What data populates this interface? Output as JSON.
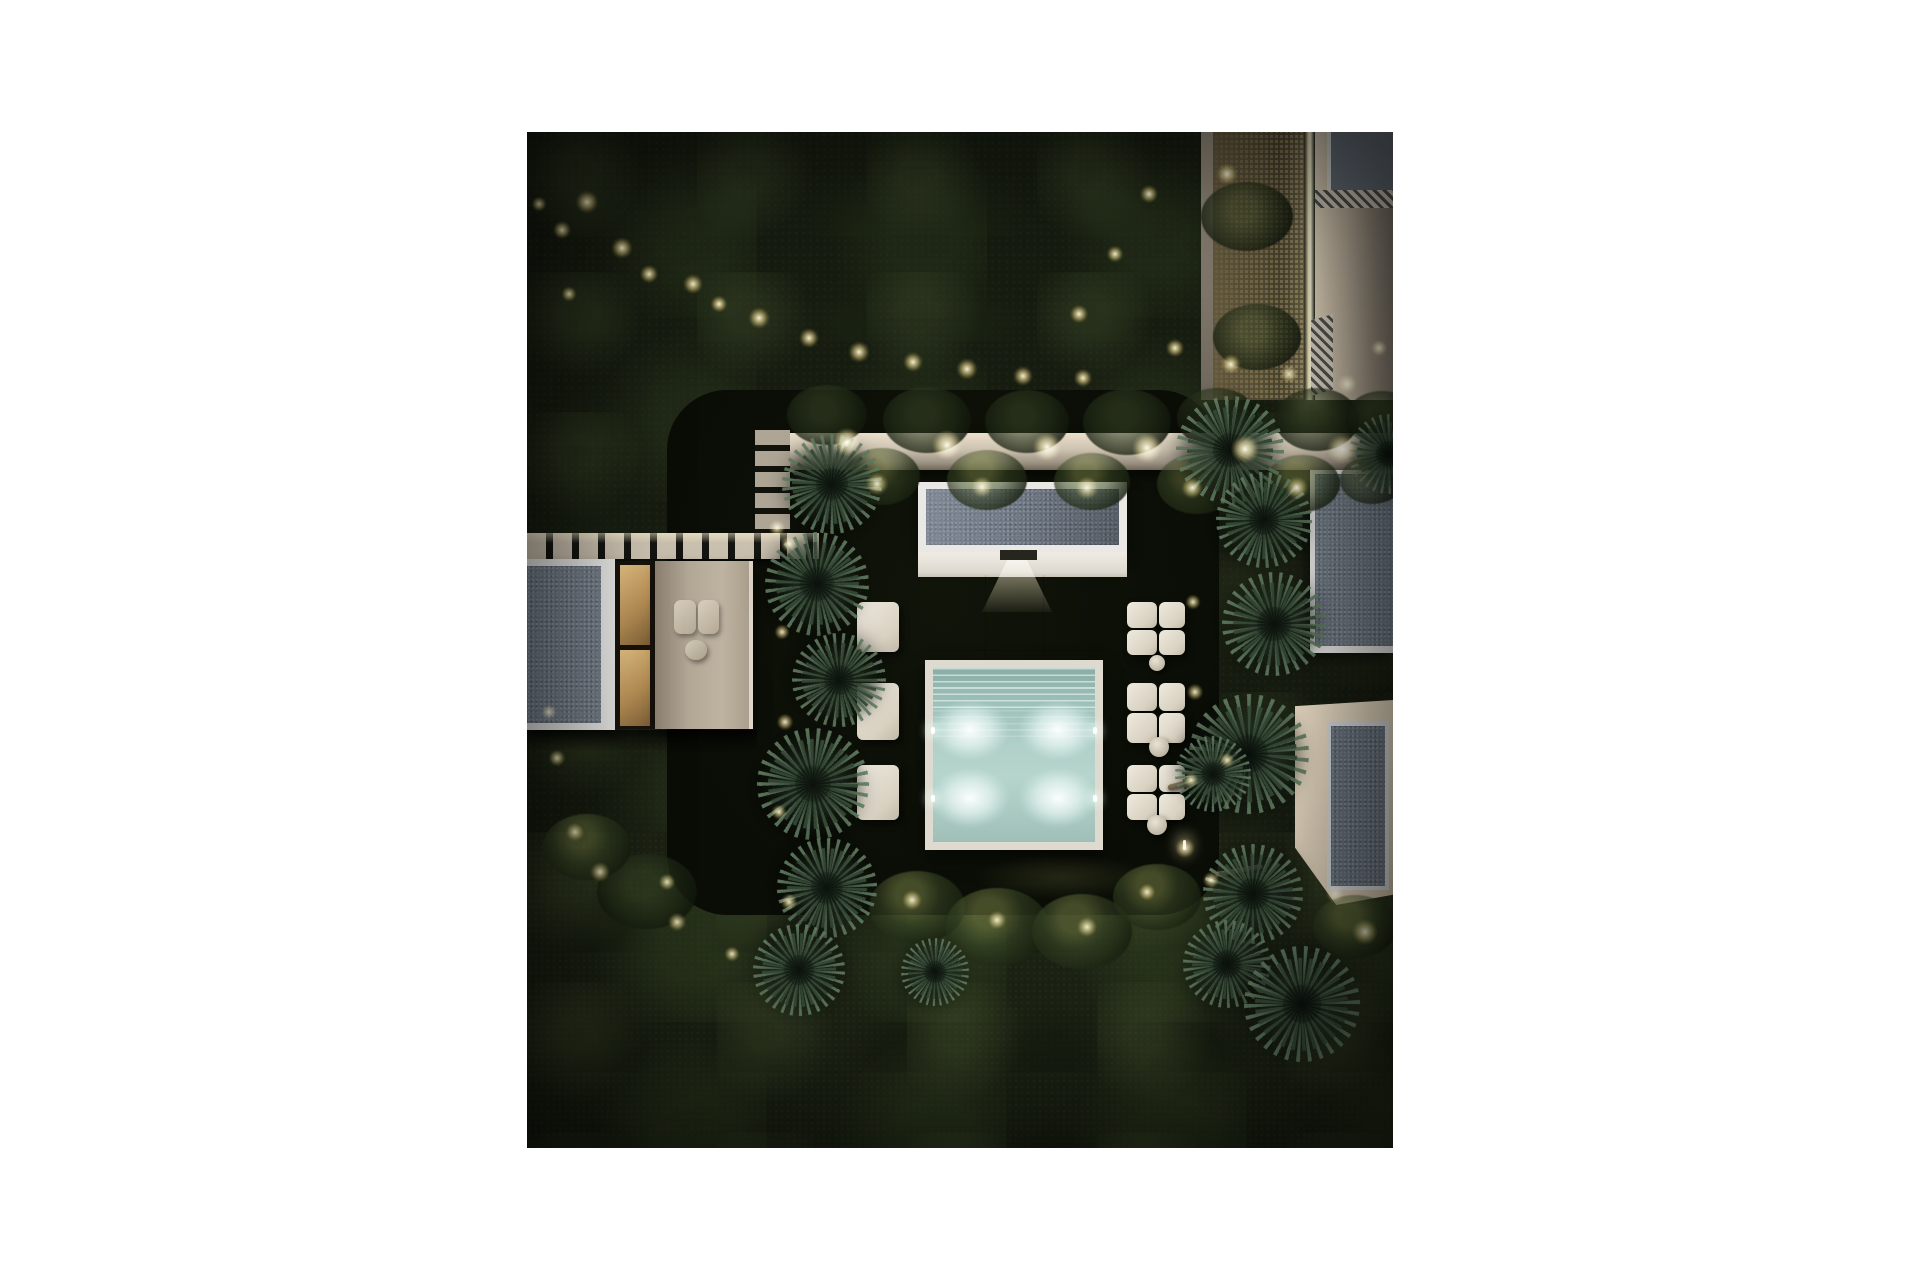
{
  "page": {
    "background_color": "#ffffff"
  },
  "scene": {
    "description": "Aerial night rendering of a modern villa garden: a glowing turquoise plunge pool with slatted cover section and four underwater lights, a flat-roofed pool pavilion, beige stone terraces, white modular sun loungers with round poufs, twin rows of yucca palms, a lit garden wall with hedges, a slatted boardwalk and paver path, neighbouring flat-roofed buildings with a back-lit lattice screen, all surrounded by dense dark tree canopy dotted with warm landscape uplights.",
    "time_of_day": "night",
    "palette": {
      "margin_white": "#ffffff",
      "canopy_dark": "#161c10",
      "canopy_moss": "#5c6c3c",
      "lawn_dark": "#0c0f08",
      "warm_light": "#f7ecc4",
      "wall_beige": "#cdc2b0",
      "roof_gray": "#707a86",
      "trim_white": "#e9e8e4",
      "terrace_beige": "#b3a896",
      "pool_teal": "#b0d0c8",
      "pool_glow": "#f4fffa",
      "lounger_cream": "#e5e0d4",
      "lattice_glow": "#b5a26a",
      "interior_warm": "#c79a5f"
    },
    "pool": {
      "underwater_light_count": 4,
      "lights": [
        {
          "x": 443,
          "y": 598
        },
        {
          "x": 443,
          "y": 666
        },
        {
          "x": 531,
          "y": 598
        },
        {
          "x": 531,
          "y": 666
        }
      ],
      "fixtures": [
        {
          "x": 404,
          "y": 595
        },
        {
          "x": 404,
          "y": 663
        },
        {
          "x": 566,
          "y": 595
        },
        {
          "x": 566,
          "y": 663
        }
      ],
      "has_slatted_cover_section": true
    },
    "garden_lights": [
      {
        "x": 60,
        "y": 70,
        "d": 30,
        "kind": "canopy"
      },
      {
        "x": 35,
        "y": 98,
        "d": 24,
        "kind": "canopy"
      },
      {
        "x": 12,
        "y": 72,
        "d": 20,
        "kind": "canopy"
      },
      {
        "x": 95,
        "y": 116,
        "d": 28,
        "kind": "canopy"
      },
      {
        "x": 122,
        "y": 142,
        "d": 24,
        "kind": "canopy"
      },
      {
        "x": 166,
        "y": 152,
        "d": 26,
        "kind": "canopy"
      },
      {
        "x": 192,
        "y": 172,
        "d": 22,
        "kind": "canopy"
      },
      {
        "x": 232,
        "y": 186,
        "d": 28,
        "kind": "canopy"
      },
      {
        "x": 282,
        "y": 206,
        "d": 26,
        "kind": "canopy"
      },
      {
        "x": 332,
        "y": 220,
        "d": 28,
        "kind": "canopy"
      },
      {
        "x": 386,
        "y": 230,
        "d": 26,
        "kind": "canopy"
      },
      {
        "x": 440,
        "y": 237,
        "d": 28,
        "kind": "canopy"
      },
      {
        "x": 496,
        "y": 244,
        "d": 26,
        "kind": "canopy"
      },
      {
        "x": 552,
        "y": 182,
        "d": 24,
        "kind": "canopy"
      },
      {
        "x": 588,
        "y": 122,
        "d": 22,
        "kind": "canopy"
      },
      {
        "x": 622,
        "y": 62,
        "d": 24,
        "kind": "canopy"
      },
      {
        "x": 700,
        "y": 42,
        "d": 28,
        "kind": "canopy"
      },
      {
        "x": 648,
        "y": 216,
        "d": 24,
        "kind": "canopy"
      },
      {
        "x": 704,
        "y": 232,
        "d": 26,
        "kind": "canopy"
      },
      {
        "x": 762,
        "y": 242,
        "d": 24,
        "kind": "canopy"
      },
      {
        "x": 820,
        "y": 252,
        "d": 26,
        "kind": "canopy"
      },
      {
        "x": 852,
        "y": 216,
        "d": 22,
        "kind": "canopy"
      },
      {
        "x": 42,
        "y": 162,
        "d": 20,
        "kind": "canopy"
      },
      {
        "x": 556,
        "y": 246,
        "d": 24,
        "kind": "canopy"
      },
      {
        "x": 320,
        "y": 310,
        "d": 36,
        "kind": "wall"
      },
      {
        "x": 420,
        "y": 313,
        "d": 38,
        "kind": "wall"
      },
      {
        "x": 520,
        "y": 315,
        "d": 36,
        "kind": "wall"
      },
      {
        "x": 620,
        "y": 316,
        "d": 38,
        "kind": "wall"
      },
      {
        "x": 718,
        "y": 317,
        "d": 36,
        "kind": "wall"
      },
      {
        "x": 815,
        "y": 317,
        "d": 38,
        "kind": "wall"
      },
      {
        "x": 350,
        "y": 352,
        "d": 30,
        "kind": "ground"
      },
      {
        "x": 455,
        "y": 355,
        "d": 28,
        "kind": "ground"
      },
      {
        "x": 560,
        "y": 356,
        "d": 30,
        "kind": "ground"
      },
      {
        "x": 665,
        "y": 356,
        "d": 28,
        "kind": "ground"
      },
      {
        "x": 770,
        "y": 356,
        "d": 30,
        "kind": "ground"
      },
      {
        "x": 250,
        "y": 396,
        "d": 22,
        "kind": "ground"
      },
      {
        "x": 262,
        "y": 412,
        "d": 22,
        "kind": "ground"
      },
      {
        "x": 255,
        "y": 500,
        "d": 20,
        "kind": "ground"
      },
      {
        "x": 258,
        "y": 590,
        "d": 22,
        "kind": "ground"
      },
      {
        "x": 252,
        "y": 680,
        "d": 20,
        "kind": "ground"
      },
      {
        "x": 262,
        "y": 770,
        "d": 22,
        "kind": "ground"
      },
      {
        "x": 666,
        "y": 470,
        "d": 20,
        "kind": "ground"
      },
      {
        "x": 668,
        "y": 560,
        "d": 22,
        "kind": "ground"
      },
      {
        "x": 664,
        "y": 648,
        "d": 20,
        "kind": "ground"
      },
      {
        "x": 658,
        "y": 716,
        "d": 26,
        "kind": "ground"
      },
      {
        "x": 684,
        "y": 748,
        "d": 22,
        "kind": "ground"
      },
      {
        "x": 385,
        "y": 768,
        "d": 26,
        "kind": "ground"
      },
      {
        "x": 470,
        "y": 788,
        "d": 24,
        "kind": "ground"
      },
      {
        "x": 560,
        "y": 795,
        "d": 26,
        "kind": "ground"
      },
      {
        "x": 620,
        "y": 760,
        "d": 22,
        "kind": "ground"
      },
      {
        "x": 700,
        "y": 628,
        "d": 20,
        "kind": "ground"
      },
      {
        "x": 48,
        "y": 700,
        "d": 24,
        "kind": "ground"
      },
      {
        "x": 73,
        "y": 740,
        "d": 26,
        "kind": "ground"
      },
      {
        "x": 140,
        "y": 750,
        "d": 22,
        "kind": "ground"
      },
      {
        "x": 150,
        "y": 790,
        "d": 24,
        "kind": "ground"
      },
      {
        "x": 205,
        "y": 822,
        "d": 20,
        "kind": "ground"
      },
      {
        "x": 838,
        "y": 800,
        "d": 34,
        "kind": "ground"
      },
      {
        "x": 808,
        "y": 762,
        "d": 24,
        "kind": "ground"
      },
      {
        "x": 22,
        "y": 580,
        "d": 20,
        "kind": "ground"
      },
      {
        "x": 30,
        "y": 626,
        "d": 22,
        "kind": "ground"
      }
    ],
    "palms": [
      {
        "x": 305,
        "y": 352,
        "r": 50,
        "rot": 10
      },
      {
        "x": 290,
        "y": 452,
        "r": 52,
        "rot": 80
      },
      {
        "x": 312,
        "y": 548,
        "r": 47,
        "rot": 160
      },
      {
        "x": 286,
        "y": 652,
        "r": 56,
        "rot": 40
      },
      {
        "x": 300,
        "y": 756,
        "r": 50,
        "rot": 120
      },
      {
        "x": 272,
        "y": 838,
        "r": 46,
        "rot": 200
      },
      {
        "x": 408,
        "y": 840,
        "r": 34,
        "rot": 60
      },
      {
        "x": 703,
        "y": 318,
        "r": 54,
        "rot": 90
      },
      {
        "x": 737,
        "y": 388,
        "r": 48,
        "rot": 30
      },
      {
        "x": 747,
        "y": 492,
        "r": 52,
        "rot": 150
      },
      {
        "x": 722,
        "y": 622,
        "r": 60,
        "rot": 70
      },
      {
        "x": 686,
        "y": 642,
        "r": 38,
        "rot": 190
      },
      {
        "x": 726,
        "y": 762,
        "r": 50,
        "rot": 250
      },
      {
        "x": 700,
        "y": 832,
        "r": 44,
        "rot": 20
      },
      {
        "x": 775,
        "y": 872,
        "r": 58,
        "rot": 110
      },
      {
        "x": 862,
        "y": 322,
        "r": 40,
        "rot": 45
      }
    ],
    "shrubs": [
      {
        "x": 355,
        "y": 345,
        "r": 38,
        "lit": true
      },
      {
        "x": 460,
        "y": 348,
        "r": 40,
        "lit": true
      },
      {
        "x": 565,
        "y": 350,
        "r": 38,
        "lit": true
      },
      {
        "x": 670,
        "y": 352,
        "r": 40,
        "lit": true
      },
      {
        "x": 775,
        "y": 352,
        "r": 38,
        "lit": true
      },
      {
        "x": 845,
        "y": 348,
        "r": 32,
        "lit": true
      },
      {
        "x": 300,
        "y": 283,
        "r": 40,
        "lit": false
      },
      {
        "x": 400,
        "y": 288,
        "r": 44,
        "lit": false
      },
      {
        "x": 500,
        "y": 290,
        "r": 42,
        "lit": false
      },
      {
        "x": 600,
        "y": 290,
        "r": 44,
        "lit": false
      },
      {
        "x": 690,
        "y": 286,
        "r": 40,
        "lit": false
      },
      {
        "x": 790,
        "y": 288,
        "r": 42,
        "lit": false
      },
      {
        "x": 855,
        "y": 286,
        "r": 36,
        "lit": false
      },
      {
        "x": 720,
        "y": 85,
        "r": 46,
        "lit": false
      },
      {
        "x": 730,
        "y": 205,
        "r": 44,
        "lit": false
      },
      {
        "x": 390,
        "y": 775,
        "r": 48,
        "lit": true
      },
      {
        "x": 470,
        "y": 795,
        "r": 52,
        "lit": true
      },
      {
        "x": 555,
        "y": 800,
        "r": 50,
        "lit": true
      },
      {
        "x": 630,
        "y": 765,
        "r": 44,
        "lit": true
      },
      {
        "x": 828,
        "y": 795,
        "r": 42,
        "lit": true
      },
      {
        "x": 120,
        "y": 760,
        "r": 50,
        "lit": false
      },
      {
        "x": 60,
        "y": 715,
        "r": 44,
        "lit": true
      }
    ],
    "loungers_right": [
      {
        "x": 600,
        "y": 470,
        "w": 30,
        "h": 26
      },
      {
        "x": 632,
        "y": 470,
        "w": 26,
        "h": 26
      },
      {
        "x": 600,
        "y": 498,
        "w": 30,
        "h": 25
      },
      {
        "x": 632,
        "y": 498,
        "w": 26,
        "h": 25
      },
      {
        "x": 600,
        "y": 551,
        "w": 30,
        "h": 28
      },
      {
        "x": 632,
        "y": 551,
        "w": 26,
        "h": 28
      },
      {
        "x": 600,
        "y": 581,
        "w": 30,
        "h": 30
      },
      {
        "x": 632,
        "y": 581,
        "w": 26,
        "h": 30
      },
      {
        "x": 600,
        "y": 633,
        "w": 30,
        "h": 27
      },
      {
        "x": 632,
        "y": 633,
        "w": 26,
        "h": 27
      },
      {
        "x": 600,
        "y": 662,
        "w": 30,
        "h": 26
      },
      {
        "x": 632,
        "y": 662,
        "w": 26,
        "h": 26
      }
    ],
    "loungers_left": [
      {
        "x": 330,
        "y": 470,
        "w": 42,
        "h": 50
      },
      {
        "x": 330,
        "y": 551,
        "w": 42,
        "h": 57
      },
      {
        "x": 330,
        "y": 633,
        "w": 42,
        "h": 55
      }
    ],
    "poufs": [
      {
        "x": 630,
        "y": 531,
        "r": 8
      },
      {
        "x": 632,
        "y": 615,
        "r": 10
      },
      {
        "x": 630,
        "y": 693,
        "r": 10
      }
    ],
    "counts": {
      "buildings": 5,
      "palm_clusters": 16,
      "sun_lounger_cushions": 15,
      "round_poufs": 3,
      "underwater_pool_lights": 4
    }
  }
}
